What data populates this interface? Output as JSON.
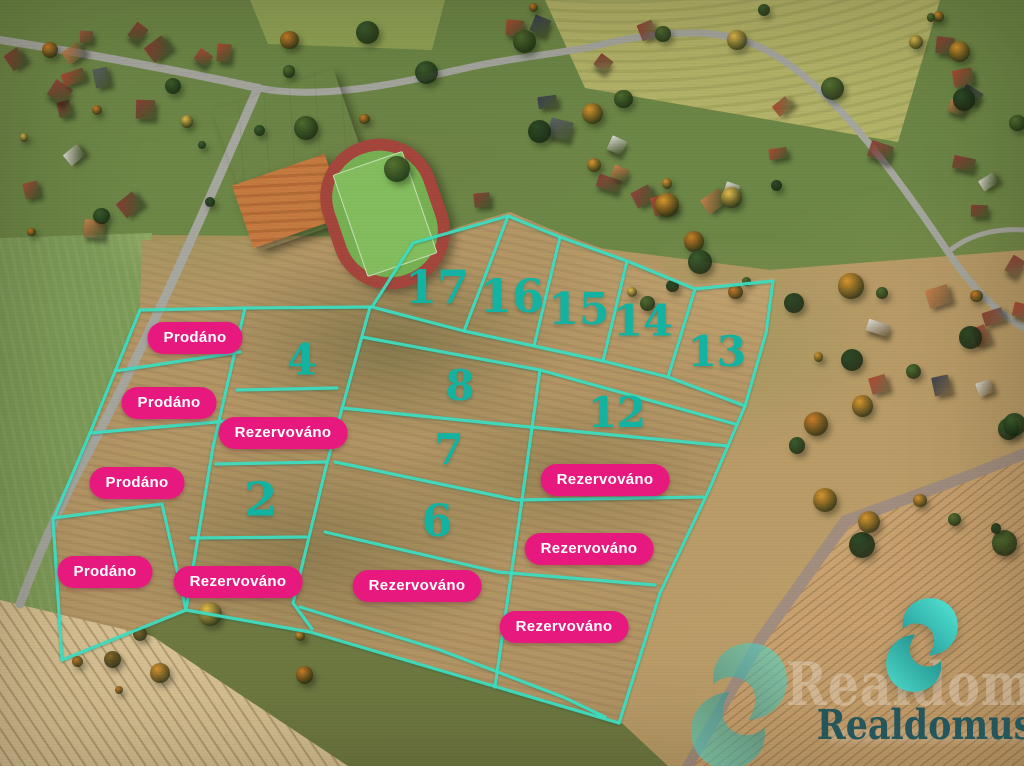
{
  "overlay": {
    "line_color": "#3edcc0",
    "number_color": "#14b3a1",
    "badge": {
      "background": "#e8197e",
      "text_color": "#ffffff"
    },
    "plots": [
      {
        "number": "17",
        "x": 437,
        "y": 287,
        "size": 46
      },
      {
        "number": "16",
        "x": 512,
        "y": 296,
        "size": 46
      },
      {
        "number": "15",
        "x": 579,
        "y": 310,
        "size": 44
      },
      {
        "number": "14",
        "x": 643,
        "y": 322,
        "size": 43
      },
      {
        "number": "13",
        "x": 717,
        "y": 352,
        "size": 42
      },
      {
        "number": "4",
        "x": 302,
        "y": 361,
        "size": 43
      },
      {
        "number": "8",
        "x": 460,
        "y": 386,
        "size": 42
      },
      {
        "number": "12",
        "x": 617,
        "y": 413,
        "size": 42
      },
      {
        "number": "7",
        "x": 449,
        "y": 450,
        "size": 42
      },
      {
        "number": "2",
        "x": 261,
        "y": 500,
        "size": 47
      },
      {
        "number": "6",
        "x": 437,
        "y": 522,
        "size": 44
      }
    ],
    "status_labels": [
      {
        "text": "Prodáno",
        "x": 195,
        "y": 338
      },
      {
        "text": "Prodáno",
        "x": 169,
        "y": 403
      },
      {
        "text": "Prodáno",
        "x": 137,
        "y": 483
      },
      {
        "text": "Prodáno",
        "x": 105,
        "y": 572
      },
      {
        "text": "Rezervováno",
        "x": 283,
        "y": 433
      },
      {
        "text": "Rezervováno",
        "x": 238,
        "y": 582
      },
      {
        "text": "Rezervováno",
        "x": 417,
        "y": 586
      },
      {
        "text": "Rezervováno",
        "x": 605,
        "y": 480
      },
      {
        "text": "Rezervováno",
        "x": 589,
        "y": 549
      },
      {
        "text": "Rezervováno",
        "x": 564,
        "y": 627
      }
    ]
  },
  "branding": {
    "logo_text": "Realdomus",
    "watermark_text": "Realdomus",
    "logo_text_color": "#24565b",
    "logo_icon_colors": {
      "dark": "#1d8f90",
      "light": "#55e8d6"
    }
  }
}
